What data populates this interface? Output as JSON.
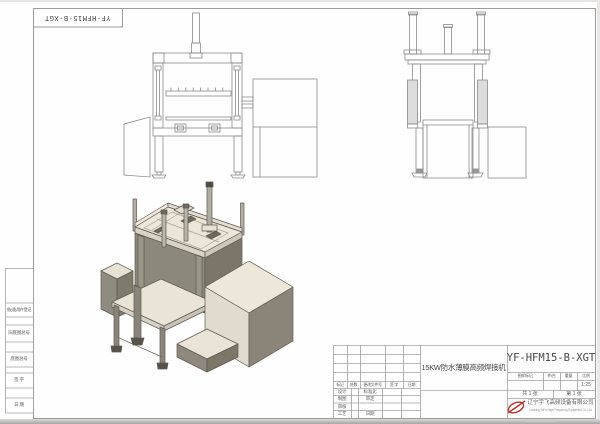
{
  "drawing": {
    "number": "YF-HFM15-B-XGT",
    "title": "15KW防水薄膜高频焊接机"
  },
  "margin_column": {
    "labels": [
      "借(通)用件登记",
      "旧底图总号",
      "底图总号",
      "签  字",
      "日  期"
    ]
  },
  "title_block": {
    "revision_headers": [
      "标记",
      "处数",
      "更改文件号",
      "签 字",
      "日期"
    ],
    "sign_rows": [
      {
        "left": "设计",
        "right": "标准化"
      },
      {
        "left": "制图",
        "right": "审定"
      },
      {
        "left": "审核",
        "right": ""
      },
      {
        "left": "工艺",
        "right": "日期"
      }
    ],
    "info_headers": [
      "图样标记",
      "件/台",
      "重量",
      "比例"
    ],
    "scale": "1:25",
    "sheet_total": "共 1 张",
    "sheet_index": "第 1 张",
    "company": "辽宁宇飞高频设备有限公司",
    "company_en": "Liaoning YuFei High Frequency Equipment Co.,Ltd."
  },
  "colors": {
    "paper": "#fefefe",
    "drawing_line": "#8a8a8a",
    "frame_line": "#9b9b9b",
    "text": "#5a5a5a",
    "iso_top_face": "#ebe6d8",
    "iso_light_face": "#e0dbcc",
    "iso_gray_face": "#8d887c",
    "iso_dark_face": "#7b7669",
    "logo_red": "#b5362b"
  }
}
